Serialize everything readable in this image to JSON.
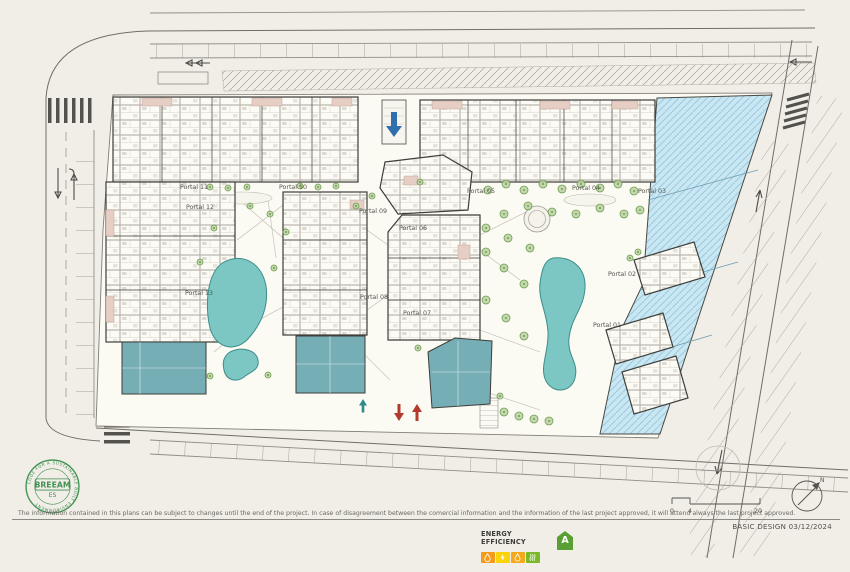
{
  "plan": {
    "portals": [
      {
        "label": "Portal 11",
        "x": 194,
        "y": 189
      },
      {
        "label": "Portal 10",
        "x": 293,
        "y": 189
      },
      {
        "label": "Portal 05",
        "x": 481,
        "y": 193
      },
      {
        "label": "Portal 04",
        "x": 586,
        "y": 190
      },
      {
        "label": "Portal 03",
        "x": 652,
        "y": 193
      },
      {
        "label": "Portal 12",
        "x": 200,
        "y": 209
      },
      {
        "label": "Portal 09",
        "x": 373,
        "y": 213
      },
      {
        "label": "Portal 06",
        "x": 413,
        "y": 230
      },
      {
        "label": "Portal 13",
        "x": 199,
        "y": 295
      },
      {
        "label": "Portal 08",
        "x": 374,
        "y": 299
      },
      {
        "label": "Portal 07",
        "x": 417,
        "y": 315
      },
      {
        "label": "Portal 02",
        "x": 622,
        "y": 276
      },
      {
        "label": "Portal 01",
        "x": 607,
        "y": 327
      }
    ],
    "trees": [
      [
        210,
        187,
        3
      ],
      [
        228,
        188,
        3
      ],
      [
        247,
        187,
        3
      ],
      [
        300,
        186,
        3
      ],
      [
        318,
        187,
        3
      ],
      [
        336,
        186,
        3
      ],
      [
        488,
        190,
        4
      ],
      [
        506,
        184,
        4
      ],
      [
        524,
        190,
        4
      ],
      [
        543,
        184,
        4
      ],
      [
        562,
        189,
        4
      ],
      [
        581,
        184,
        4
      ],
      [
        600,
        188,
        4
      ],
      [
        618,
        184,
        4
      ],
      [
        634,
        191,
        4
      ],
      [
        640,
        210,
        4
      ],
      [
        624,
        214,
        4
      ],
      [
        600,
        208,
        4
      ],
      [
        576,
        214,
        4
      ],
      [
        552,
        212,
        4
      ],
      [
        528,
        206,
        4
      ],
      [
        504,
        214,
        4
      ],
      [
        486,
        228,
        4
      ],
      [
        508,
        238,
        4
      ],
      [
        530,
        248,
        4
      ],
      [
        486,
        252,
        4
      ],
      [
        504,
        268,
        4
      ],
      [
        524,
        284,
        4
      ],
      [
        486,
        300,
        4
      ],
      [
        506,
        318,
        4
      ],
      [
        524,
        336,
        4
      ],
      [
        504,
        412,
        4
      ],
      [
        519,
        416,
        4
      ],
      [
        534,
        419,
        4
      ],
      [
        549,
        421,
        4
      ],
      [
        250,
        206,
        3
      ],
      [
        270,
        214,
        3
      ],
      [
        214,
        228,
        3
      ],
      [
        286,
        232,
        3
      ],
      [
        200,
        262,
        3
      ],
      [
        274,
        268,
        3
      ],
      [
        210,
        376,
        3
      ],
      [
        268,
        375,
        3
      ],
      [
        372,
        196,
        3
      ],
      [
        356,
        206,
        3
      ],
      [
        420,
        182,
        3
      ],
      [
        418,
        348,
        3
      ],
      [
        500,
        396,
        3
      ],
      [
        638,
        252,
        3
      ],
      [
        630,
        258,
        3
      ]
    ],
    "markers": [
      {
        "name": "garage-ramp-arrow",
        "color": "#2f6fae"
      },
      {
        "name": "pedestrian-entry-arrow",
        "color": "#2e8b8b"
      },
      {
        "name": "vehicle-exit-arrow",
        "color": "#b23a2e"
      },
      {
        "name": "vehicle-entry-arrow",
        "color": "#b23a2e"
      }
    ],
    "colors": {
      "paper": "#f0eee6",
      "pool": "#7cc7c3",
      "commercial": "#76aeb6",
      "retail_zone": "#c9e7f3",
      "terrace_pink": "#e6cec5",
      "tree_green": "#6f9e4f",
      "entry_red": "#b23a2e",
      "garage_blue": "#2f6fae",
      "breeam_green": "#3f9051"
    }
  },
  "footer": {
    "disclaimer": "The information contained in this plans can be subject to changes until the end of the project. In case of disagreement between the comercial information and the information of the last project approved, it will attend always the last project approved.",
    "stamp": "BASIC DESIGN 03/12/2024"
  },
  "breeam": {
    "name": "BREEAM",
    "region": "ES",
    "ring": "CODE FOR A SUSTAINABLE BUILT ENVIRONMENT"
  },
  "energy": {
    "label": "ENERGY EFFICIENCY",
    "rating": "A",
    "meters": [
      {
        "name": "water",
        "color": "#f39b1d"
      },
      {
        "name": "electricity",
        "color": "#fcd307"
      },
      {
        "name": "heating",
        "color": "#f6a81c"
      },
      {
        "name": "emissions",
        "color": "#7ab929"
      }
    ]
  },
  "scalebar": {
    "ticks": [
      "0",
      "4",
      "20"
    ]
  },
  "north": {
    "label": "N"
  }
}
